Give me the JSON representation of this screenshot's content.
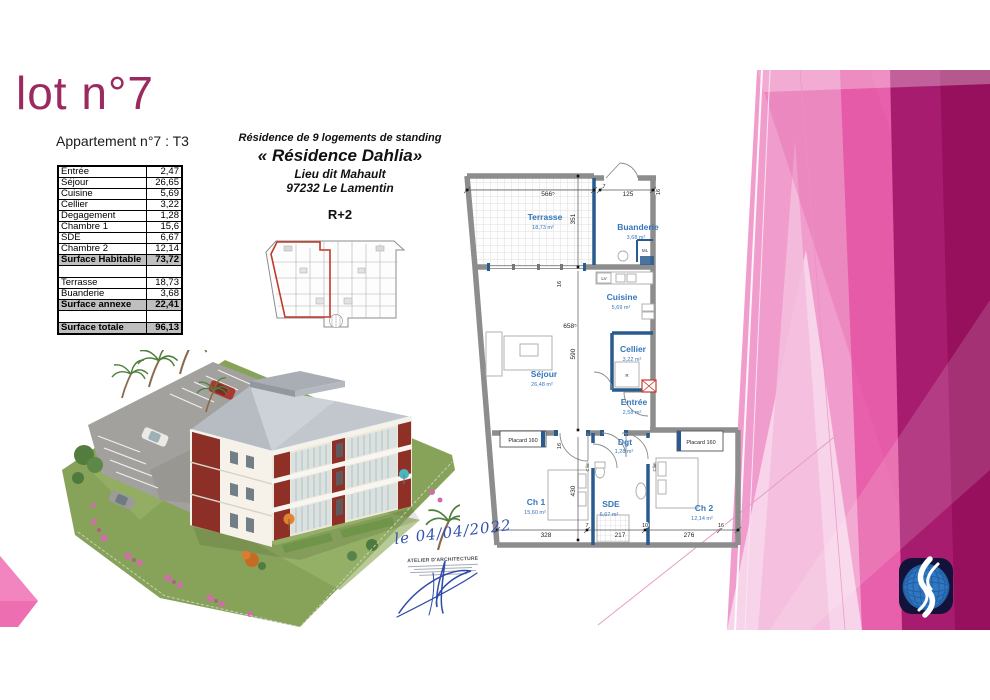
{
  "title": "lot n°7",
  "apartment_table": {
    "heading": "Appartement n°7 : T3",
    "rows": [
      {
        "label": "Entrée",
        "value": "2,47",
        "style": "normal"
      },
      {
        "label": "Séjour",
        "value": "26,65",
        "style": "normal"
      },
      {
        "label": "Cuisine",
        "value": "5,69",
        "style": "normal"
      },
      {
        "label": "Cellier",
        "value": "3,22",
        "style": "normal"
      },
      {
        "label": "Degagement",
        "value": "1,28",
        "style": "normal"
      },
      {
        "label": "Chambre 1",
        "value": "15,6",
        "style": "normal"
      },
      {
        "label": "SDE",
        "value": "6,67",
        "style": "normal"
      },
      {
        "label": "Chambre 2",
        "value": "12,14",
        "style": "normal"
      },
      {
        "label": "Surface Habitable",
        "value": "73,72",
        "style": "summary"
      },
      {
        "label": "",
        "value": "",
        "style": "spacer"
      },
      {
        "label": "Terrasse",
        "value": "18,73",
        "style": "normal"
      },
      {
        "label": "Buanderie",
        "value": "3,68",
        "style": "normal"
      },
      {
        "label": "Surface annexe",
        "value": "22,41",
        "style": "summary"
      },
      {
        "label": "",
        "value": "",
        "style": "spacer"
      },
      {
        "label": "Surface totale",
        "value": "96,13",
        "style": "summary"
      }
    ]
  },
  "residence_header": {
    "line1": "Résidence de 9 logements de standing",
    "name": "« Résidence Dahlia»",
    "place": "Lieu dit Mahault",
    "city": "97232 Le Lamentin",
    "level": "R+2"
  },
  "floorplan": {
    "rooms": {
      "terrasse": {
        "name": "Terrasse",
        "area": "18,73 m²"
      },
      "buanderie": {
        "name": "Buanderie",
        "area": "3,68 m²"
      },
      "cuisine": {
        "name": "Cuisine",
        "area": "5,69 m²"
      },
      "cellier": {
        "name": "Cellier",
        "area": "3,22 m²"
      },
      "sejour": {
        "name": "Séjour",
        "area": "26,48 m²"
      },
      "entree": {
        "name": "Entrée",
        "area": "2,58 m²"
      },
      "dgt": {
        "name": "Dgt",
        "area": "1,28 m²"
      },
      "ch1": {
        "name": "Ch 1",
        "area": "15,60 m²"
      },
      "sde": {
        "name": "SDE",
        "area": "6,67 m²"
      },
      "ch2": {
        "name": "Ch 2",
        "area": "12,14 m²"
      }
    },
    "labels": {
      "placard_left": "Placard 160",
      "placard_right": "Placard 160",
      "ml": "ML",
      "lv": "LV",
      "fridge": "R",
      "clim_left": "Clim",
      "clim_right": "Clim"
    },
    "dims": {
      "top_566": "566⁵",
      "v_351": "351",
      "top_7": "7",
      "top_125": "125",
      "top_16": "16",
      "mid_16": "16",
      "mid_658": "658⁵",
      "v_590": "590",
      "low_16": "16",
      "v_430": "430",
      "b_328": "328",
      "b_7": "7",
      "b_217": "217",
      "b_10": "10",
      "b_276": "276",
      "b_16": "16"
    }
  },
  "handwriting": {
    "date": "le 04/04/2022"
  },
  "stamp": {
    "title": "ATELIER D'ARCHITECTURE"
  },
  "colors": {
    "title_magenta": "#9b2a5e",
    "pink_dark": "#a81c70",
    "pink_mid": "#e860ab",
    "pink_light": "#f2a9d4",
    "plan_text_blue": "#3576bb",
    "plan_wall_blue": "#2a5b8f",
    "door_red": "#c0392b",
    "table_summary_gray": "#bfbfbf",
    "logo_navy": "#13123a",
    "logo_blue": "#2f77c0",
    "ink_blue": "#3353ad"
  }
}
